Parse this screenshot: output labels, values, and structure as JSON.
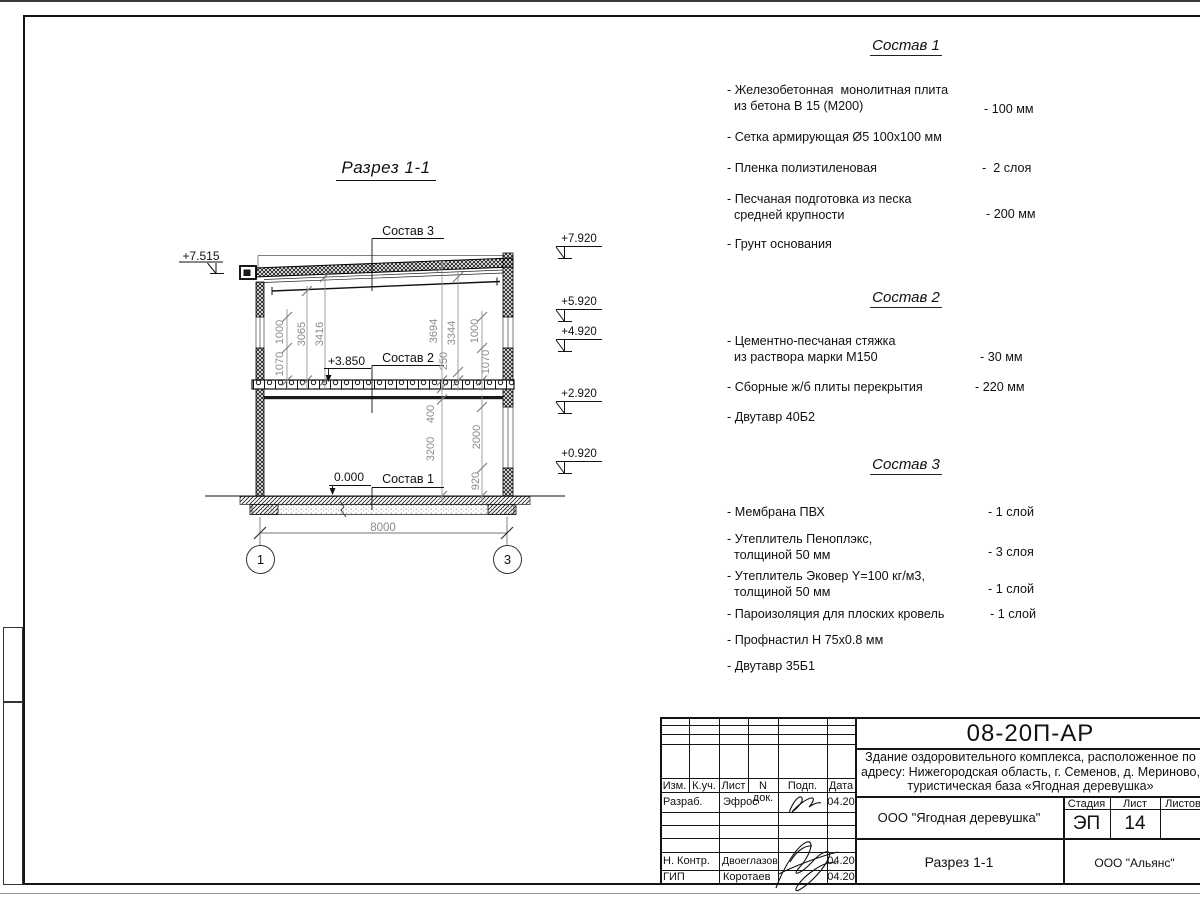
{
  "section": {
    "title": "Разрез 1-1",
    "leaders": {
      "s3": "Состав 3",
      "s2": "Состав 2",
      "s1": "Состав 1"
    },
    "levels": {
      "left_top": "+7.515",
      "mid": "+3.850",
      "zero": "0.000"
    },
    "elevations": [
      "+7.920",
      "+5.920",
      "+4.920",
      "+2.920",
      "+0.920"
    ],
    "dims": [
      "1000",
      "1070",
      "3065",
      "3416",
      "3694",
      "3344",
      "250",
      "1000",
      "1070",
      "400",
      "3200",
      "2000",
      "920"
    ],
    "span": "8000",
    "axes": [
      "1",
      "3"
    ]
  },
  "lists": [
    {
      "title": "Состав 1",
      "items": [
        {
          "name": "- Железобетонная  монолитная плита\n  из бетона В 15 (М200)",
          "value": "- 100 мм"
        },
        {
          "name": "- Сетка армирующая Ø5 100x100 мм",
          "value": ""
        },
        {
          "name": "- Пленка полиэтиленовая",
          "value": "-  2 слоя"
        },
        {
          "name": "- Песчаная подготовка из песка\n  средней крупности",
          "value": "- 200 мм"
        },
        {
          "name": "- Грунт основания",
          "value": ""
        }
      ]
    },
    {
      "title": "Состав 2",
      "items": [
        {
          "name": "- Цементно-песчаная стяжка\n  из раствора марки М150",
          "value": "- 30 мм"
        },
        {
          "name": "- Сборные ж/б плиты перекрытия",
          "value": "- 220 мм"
        },
        {
          "name": "- Двутавр 40Б2",
          "value": ""
        }
      ]
    },
    {
      "title": "Состав 3",
      "items": [
        {
          "name": "- Мембрана ПВХ",
          "value": "- 1 слой"
        },
        {
          "name": "- Утеплитель Пеноплэкс,\n  толщиной 50 мм",
          "value": "- 3 слоя"
        },
        {
          "name": "- Утеплитель Эковер Y=100 кг/м3,\n  толщиной 50 мм",
          "value": "- 1 слой"
        },
        {
          "name": "- Пароизоляция для плоских кровель",
          "value": "- 1 слой"
        },
        {
          "name": "- Профнастил Н 75x0.8 мм",
          "value": ""
        },
        {
          "name": "- Двутавр 35Б1",
          "value": ""
        }
      ]
    }
  ],
  "titleblock": {
    "doc_code": "08-20П-АР",
    "project_line1": "Здание оздоровительного комплекса, расположенное по",
    "project_line2": "адресу: Нижегородская область, г. Семенов, д. Мериново,",
    "project_line3": "туристическая база «Ягодная деревушка»",
    "client": "ООО \"Ягодная деревушка\"",
    "sheet_title": "Разрез 1-1",
    "company": "ООО \"Альянс\"",
    "stage_label": "Стадия",
    "stage": "ЭП",
    "sheet_label": "Лист",
    "sheet_number": "14",
    "sheets_label": "Листов",
    "cols": {
      "izm": "Изм.",
      "kuch": "К.уч.",
      "list": "Лист",
      "ndoc": "N док.",
      "podp": "Подп.",
      "data": "Дата"
    },
    "rows": [
      {
        "role": "Разраб.",
        "name": "Эфрос",
        "date": "04.20"
      },
      {
        "role": "Н. Контр.",
        "name": "Двоеглазов",
        "date": "04.20"
      },
      {
        "role": "ГИП",
        "name": "Коротаев",
        "date": "04.20"
      }
    ]
  }
}
